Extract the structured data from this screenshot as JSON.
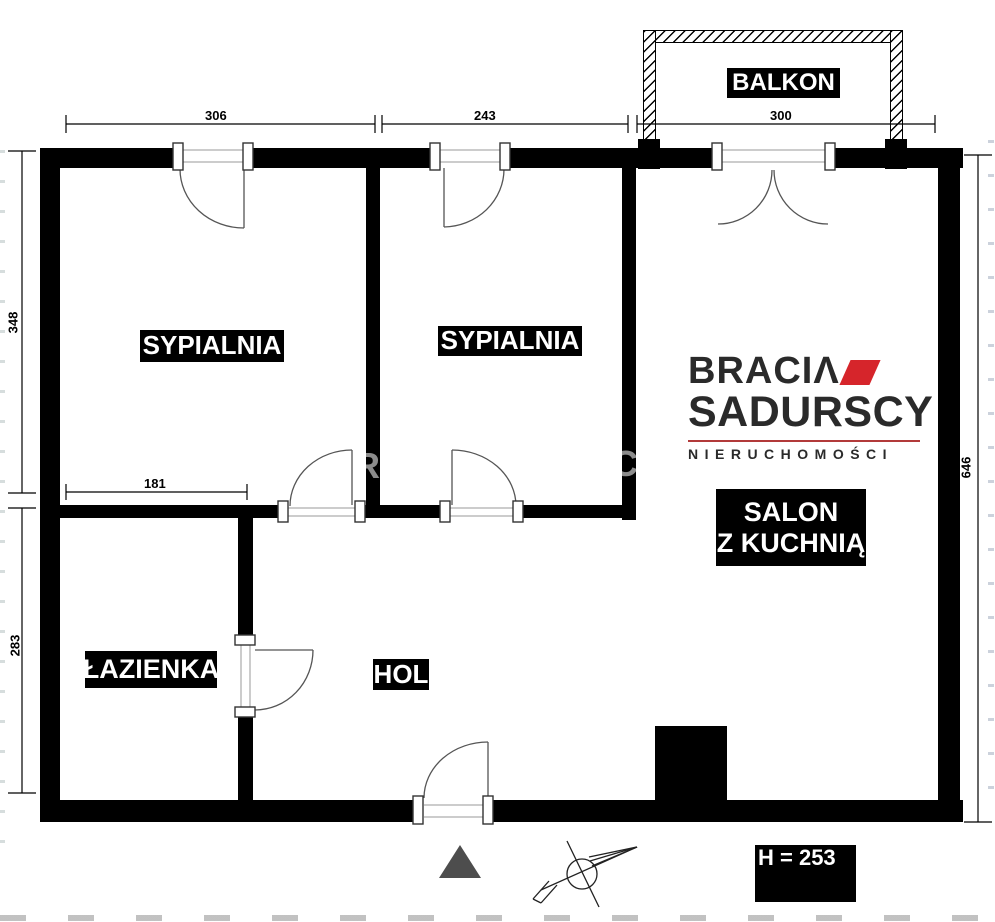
{
  "rooms": {
    "balkon": "BALKON",
    "sypialnia_1": "SYPIALNIA",
    "sypialnia_2": "SYPIALNIA",
    "salon_line1": "SALON",
    "salon_line2": "Z KUCHNIĄ",
    "lazienka": "ŁAZIENKA",
    "hol": "HOL"
  },
  "dimensions": {
    "top_bedroom1": "306",
    "top_bedroom2": "243",
    "top_balcony": "300",
    "left_upper": "348",
    "left_lower": "283",
    "right_side": "646",
    "bathroom_width": "181",
    "ceiling_height": "H = 253"
  },
  "logo": {
    "line1": "BRACIΛ",
    "line2": "SADURSCY",
    "line3": "NIERUCHOMOŚCI",
    "accent_color": "#d6252b",
    "text_color": "#2a2a2a"
  },
  "watermark": {
    "wall_a_letter": "R",
    "wall_b_letter": "C"
  },
  "colors": {
    "wall": "#000000",
    "door_line": "#555555",
    "north_triangle": "#4d4d4d"
  }
}
